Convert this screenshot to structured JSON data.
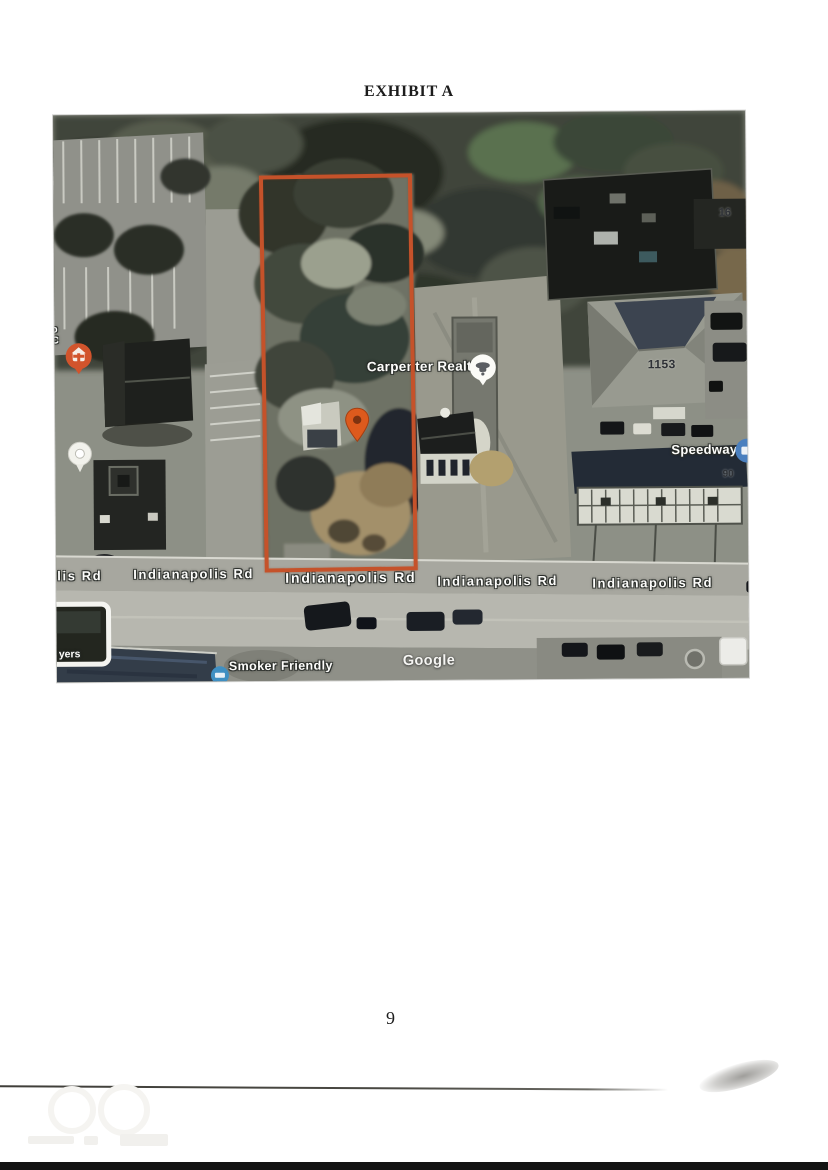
{
  "document": {
    "title": "EXHIBIT A",
    "page_number": "9"
  },
  "map": {
    "attribution": "Google",
    "pois": {
      "carpenter": {
        "label": "Carpenter Realtors"
      },
      "speedway": {
        "label": "Speedway"
      },
      "smoker_friendly": {
        "label": "Smoker Friendly"
      }
    },
    "address_labels": {
      "a16": "16",
      "a1153": "1153",
      "a90": "90"
    },
    "road_labels": [
      {
        "text": "lis Rd"
      },
      {
        "text": "Indianapolis Rd"
      },
      {
        "text": "Indianapolis Rd"
      },
      {
        "text": "Indianapolis Rd"
      },
      {
        "text": "Indianapolis Rd"
      }
    ],
    "fragments": {
      "left_edge_top": "o",
      "left_edge_bottom": "C",
      "bottom_left": "yers"
    },
    "colors": {
      "boundary": "#c5522a",
      "location_pin": "#dd5a1d",
      "speedway_icon": "#4b80bf",
      "smoker_icon": "#3f8fc2",
      "medical_icon": "#d2542c"
    }
  }
}
